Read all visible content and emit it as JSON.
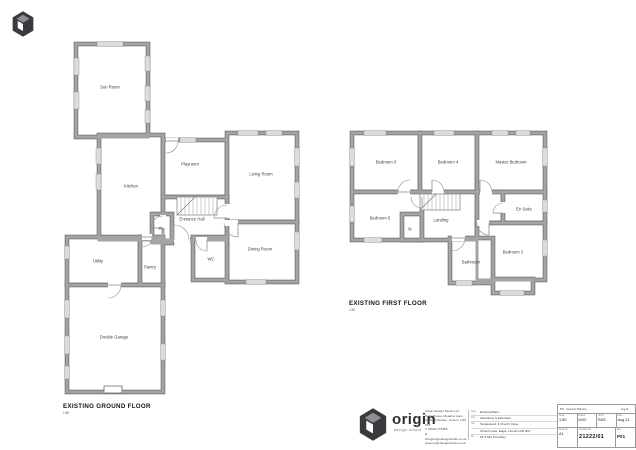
{
  "colors": {
    "wall_edge": "#6f6f6f",
    "wall_core": "#a4a4a4",
    "window_fill": "#dcdcdc",
    "door_arc": "#909090",
    "label": "#3c3c3c",
    "title": "#141414",
    "logo_dark": "#3a3a3e",
    "logo_mid": "#8e8e94",
    "logo_light": "#ffffff"
  },
  "plans": [
    {
      "id": "ground",
      "title": "EXISTING GROUND FLOOR",
      "scale": "1:50",
      "title_pos": {
        "x": 63,
        "y": 408
      },
      "rooms": [
        {
          "label": "Sun Room",
          "x": 76,
          "y": 44,
          "w": 72,
          "h": 93,
          "lx": 110,
          "ly": 87
        },
        {
          "label": "Kitchen",
          "x": 99,
          "y": 135,
          "w": 64,
          "h": 105,
          "lx": 131,
          "ly": 186
        },
        {
          "label": "Playroom",
          "x": 163,
          "y": 140,
          "w": 64,
          "h": 57,
          "lx": 190,
          "ly": 164
        },
        {
          "label": "Living Room",
          "x": 227,
          "y": 133,
          "w": 70,
          "h": 89,
          "lx": 261,
          "ly": 174
        },
        {
          "label": "Entrance Hall",
          "x": 163,
          "y": 197,
          "w": 64,
          "h": 43,
          "lx": 192,
          "ly": 219
        },
        {
          "label": "Dining Room",
          "x": 227,
          "y": 222,
          "w": 70,
          "h": 60,
          "lx": 260,
          "ly": 249
        },
        {
          "label": "WC",
          "x": 193,
          "y": 237,
          "w": 34,
          "h": 43,
          "lx": 211,
          "ly": 259
        },
        {
          "label": "st",
          "x": 152,
          "y": 214,
          "w": 20,
          "h": 29,
          "lx": 160,
          "ly": 228
        },
        {
          "label": "Utility",
          "x": 67,
          "y": 237,
          "w": 73,
          "h": 48,
          "lx": 98,
          "ly": 261
        },
        {
          "label": "Pantry",
          "x": 140,
          "y": 237,
          "w": 23,
          "h": 48,
          "lx": 150,
          "ly": 267
        },
        {
          "label": "Double Garage",
          "x": 67,
          "y": 285,
          "w": 96,
          "h": 107,
          "lx": 114,
          "ly": 337
        }
      ],
      "windows": [
        [
          97,
          41.5,
          26,
          5
        ],
        [
          74,
          58,
          5,
          17
        ],
        [
          74,
          92,
          5,
          17
        ],
        [
          145,
          56,
          5,
          15
        ],
        [
          145,
          86,
          5,
          15
        ],
        [
          145,
          110,
          5,
          13
        ],
        [
          96,
          148,
          5,
          16
        ],
        [
          96,
          174,
          5,
          16
        ],
        [
          180,
          137.5,
          16,
          5
        ],
        [
          238,
          130.5,
          20,
          5
        ],
        [
          266,
          130.5,
          16,
          5
        ],
        [
          294.5,
          148,
          5,
          18
        ],
        [
          294.5,
          182,
          5,
          16
        ],
        [
          294.5,
          232,
          5,
          18
        ],
        [
          246,
          279.5,
          20,
          5
        ],
        [
          64.5,
          246,
          5,
          13
        ],
        [
          64.5,
          300,
          5,
          18
        ],
        [
          64.5,
          336,
          5,
          18
        ],
        [
          64.5,
          366,
          5,
          13
        ],
        [
          160.5,
          300,
          5,
          16
        ],
        [
          160.5,
          344,
          5,
          16
        ]
      ],
      "doors": [
        {
          "x": 166,
          "y": 141,
          "r": 12,
          "a1": 0,
          "a2": 90,
          "gap": [
            166,
            138,
            12,
            6
          ]
        },
        {
          "x": 227,
          "y": 218,
          "r": 13,
          "a1": 180,
          "a2": 270,
          "gap": [
            224,
            204,
            6,
            14
          ]
        },
        {
          "x": 238,
          "y": 223,
          "r": 14,
          "a1": 90,
          "a2": 180,
          "gap": [
            223,
            220,
            15,
            6
          ]
        },
        {
          "x": 207,
          "y": 240,
          "r": 11,
          "a1": 90,
          "a2": 180,
          "gap": [
            196,
            237,
            11,
            6
          ]
        },
        {
          "x": 174,
          "y": 240,
          "r": 15,
          "a1": 270,
          "a2": 360,
          "gap": [
            174,
            237,
            16,
            6
          ]
        },
        {
          "x": 163,
          "y": 228,
          "r": 12,
          "a1": 180,
          "a2": 270,
          "gap": [
            160,
            215,
            6,
            13
          ]
        },
        {
          "x": 108,
          "y": 285,
          "r": 13,
          "a1": 0,
          "a2": 90,
          "gap": [
            108,
            282,
            13,
            6
          ]
        },
        {
          "x": 142,
          "y": 237,
          "r": 10,
          "a1": 0,
          "a2": 90,
          "gap": [
            142,
            234,
            10,
            6
          ]
        }
      ],
      "stairs": {
        "x": 177,
        "y": 197,
        "w": 40,
        "h": 18,
        "diag": [
          177,
          215,
          195,
          197
        ]
      },
      "extras": [
        {
          "x": 104,
          "y": 386,
          "w": 18,
          "h": 7
        }
      ]
    },
    {
      "id": "first",
      "title": "EXISTING FIRST FLOOR",
      "scale": "1:50",
      "title_pos": {
        "x": 349,
        "y": 305
      },
      "rooms": [
        {
          "label": "Bedroom 3",
          "x": 352,
          "y": 133,
          "w": 68,
          "h": 59,
          "lx": 386,
          "ly": 162
        },
        {
          "label": "Bedroom 4",
          "x": 420,
          "y": 133,
          "w": 57,
          "h": 59,
          "lx": 448,
          "ly": 162
        },
        {
          "label": "Master Bedroom",
          "x": 477,
          "y": 133,
          "w": 68,
          "h": 59,
          "lx": 511,
          "ly": 162
        },
        {
          "label": "Bedroom 5",
          "x": 352,
          "y": 192,
          "w": 70,
          "h": 48,
          "lx": 380,
          "ly": 218
        },
        {
          "label": "fs",
          "x": 402,
          "y": 214,
          "w": 20,
          "h": 26,
          "lx": 410,
          "ly": 229
        },
        {
          "label": "Landing",
          "x": 422,
          "y": 192,
          "w": 55,
          "h": 48,
          "lx": 441,
          "ly": 220
        },
        {
          "label": "",
          "x": 477,
          "y": 192,
          "w": 26,
          "h": 31,
          "lx": 0,
          "ly": 0
        },
        {
          "label": "En Suite",
          "x": 503,
          "y": 192,
          "w": 42,
          "h": 31,
          "lx": 524,
          "ly": 209
        },
        {
          "label": "Bedroom 2",
          "x": 477,
          "y": 223,
          "w": 68,
          "h": 57,
          "lx": 513,
          "ly": 252
        },
        {
          "label": "Bathroom",
          "x": 450,
          "y": 238,
          "w": 43,
          "h": 45,
          "lx": 471,
          "ly": 262
        },
        {
          "label": "",
          "x": 493,
          "y": 279,
          "w": 40,
          "h": 14,
          "lx": 0,
          "ly": 0
        }
      ],
      "windows": [
        [
          364,
          130.5,
          22,
          5
        ],
        [
          434,
          130.5,
          20,
          5
        ],
        [
          492,
          130.5,
          16,
          5
        ],
        [
          516,
          130.5,
          14,
          5
        ],
        [
          349.5,
          148,
          5,
          18
        ],
        [
          349.5,
          206,
          5,
          16
        ],
        [
          542.5,
          148,
          5,
          18
        ],
        [
          542.5,
          200,
          5,
          12
        ],
        [
          542.5,
          240,
          5,
          16
        ],
        [
          364,
          237.5,
          18,
          5
        ],
        [
          456,
          280.5,
          16,
          5
        ],
        [
          500,
          290.5,
          24,
          5
        ]
      ],
      "doors": [
        {
          "x": 410,
          "y": 192,
          "r": 12,
          "a1": 180,
          "a2": 270,
          "gap": [
            398,
            189,
            12,
            6
          ]
        },
        {
          "x": 432,
          "y": 192,
          "r": 12,
          "a1": 270,
          "a2": 360,
          "gap": [
            432,
            189,
            12,
            6
          ]
        },
        {
          "x": 480,
          "y": 192,
          "r": 12,
          "a1": 270,
          "a2": 360,
          "gap": [
            480,
            189,
            12,
            6
          ]
        },
        {
          "x": 422,
          "y": 197,
          "r": 11,
          "a1": 90,
          "a2": 180,
          "gap": [
            419,
            197,
            6,
            11
          ]
        },
        {
          "x": 503,
          "y": 213,
          "r": 10,
          "a1": 180,
          "a2": 270,
          "gap": [
            500,
            202,
            6,
            11
          ]
        },
        {
          "x": 489,
          "y": 223,
          "r": 12,
          "a1": 90,
          "a2": 180,
          "gap": [
            477,
            220,
            12,
            6
          ]
        },
        {
          "x": 452,
          "y": 238,
          "r": 13,
          "a1": 0,
          "a2": 90,
          "gap": [
            452,
            235,
            13,
            6
          ]
        }
      ],
      "stairs": {
        "x": 420,
        "y": 194,
        "w": 40,
        "h": 16,
        "diag": [
          420,
          210,
          436,
          194
        ]
      },
      "extras": []
    }
  ],
  "logo": {
    "wordmark": "origin",
    "tagline": "design studio"
  },
  "title_block": {
    "address_lines": [
      "Origin Design Studio Ltd",
      "Holly House, Meadow Lane",
      "South Hykeham, Lincoln, LN6 9PF",
      "T 01522 775356",
      "E info@origindesignstudio.co.uk",
      "www.origindesignstudio.co.uk"
    ],
    "project_lines": [
      {
        "label": "Dwg",
        "text": "Existing Plans"
      },
      {
        "label": "Proj",
        "text": "Alterations & Extension"
      },
      {
        "label": "Site",
        "text": "Tanglewood, 9 Church Close"
      },
      {
        "label": "",
        "text": "Church Lane, Eagle, Lincoln LN6 9DJ"
      },
      {
        "label": "Clt",
        "text": "Mr & Mrs M Godley"
      }
    ],
    "revision": {
      "rev": "P01",
      "description": "Issued for Planning",
      "date": "Aug 21"
    },
    "fields": {
      "scale_label": "Scale",
      "scale": "1:50",
      "drawn_label": "Drawn",
      "drawn": "MJG",
      "checked_label": "Chkd",
      "checked": "RAS",
      "date_label": "Date",
      "date": "Aug 21",
      "paper_label": "Scale @",
      "paper": "A1",
      "number_label": "Drawing No",
      "number": "21222/01",
      "rev_label": "Rev",
      "rev": "P01"
    }
  }
}
